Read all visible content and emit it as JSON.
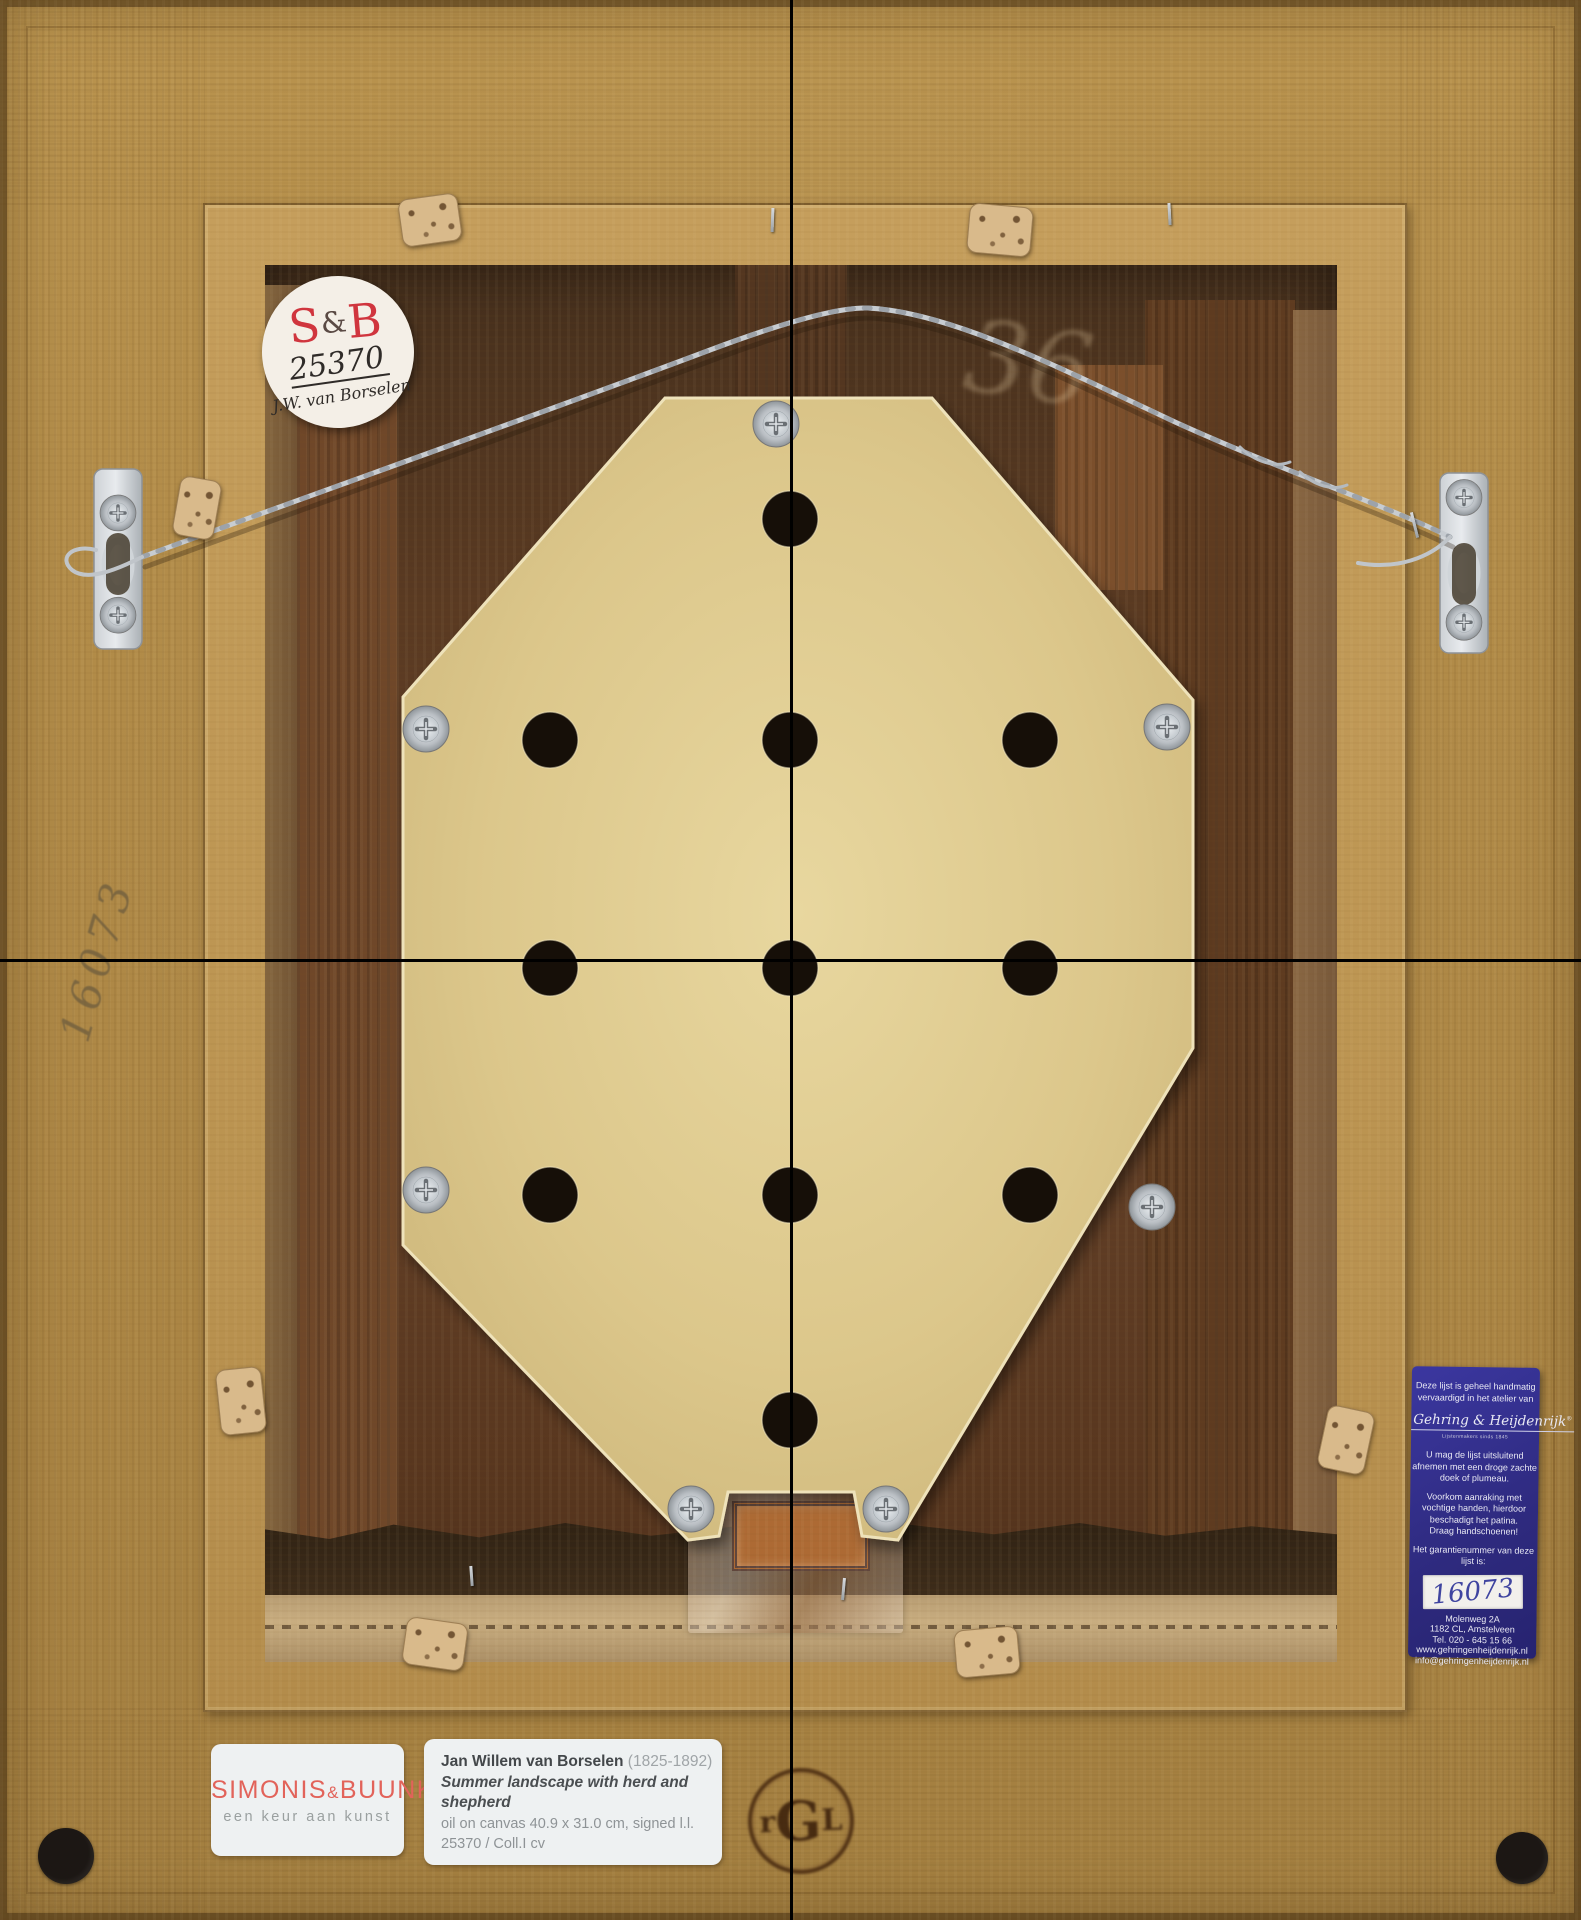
{
  "round_sticker": {
    "brand_s": "S",
    "brand_amp": "&",
    "brand_b": "B",
    "number": "25370",
    "artist": "J.W. van Borselen"
  },
  "frame_markings": {
    "pencil_number": "16073",
    "chalk_number": "36"
  },
  "blue_label": {
    "intro_lines": [
      "Deze lijst is geheel handmatig",
      "vervaardigd in het atelier van"
    ],
    "logo": "Gehring & Heijdenrijk",
    "logo_reg": "®",
    "tagline": "Lijstenmakers sinds 1845",
    "care_lines": [
      "U mag de lijst uitsluitend",
      "afnemen met een droge zachte",
      "doek of plumeau."
    ],
    "warning_lines": [
      "Voorkom aanraking met",
      "vochtige handen, hierdoor",
      "beschadigt het patina.",
      "Draag handschoenen!"
    ],
    "guarantee_lines": [
      "Het garantienummer van deze",
      "lijst is:"
    ],
    "guarantee_number": "16073",
    "address_lines": [
      "Molenweg 2A",
      "1182 CL, Amstelveen",
      "Tel. 020 - 645 15 66",
      "www.gehringenheijdenrijk.nl",
      "info@gehringenheijdenrijk.nl"
    ]
  },
  "gallery_label": {
    "name1": "SIMONIS",
    "amp": "&",
    "name2": "BUUNK",
    "tagline": "een keur aan kunst"
  },
  "artwork_label": {
    "artist": "Jan Willem van Borselen ",
    "years": "(1825-1892)",
    "title_line1": "Summer landscape with herd and",
    "title_line2": "shepherd",
    "medium": "oil on canvas 40.9 x 31.0 cm, signed l.l.",
    "inventory": "25370 / Coll.I cv"
  },
  "brand_stamp": {
    "l1": "r",
    "l2": "G",
    "l3": "L"
  },
  "colors": {
    "frame_gold": "#b5904b",
    "board_cream": "#d8c389",
    "label_blue": "#2e2a7e",
    "sb_red": "#d0353e",
    "gallery_red": "#e2635a"
  }
}
